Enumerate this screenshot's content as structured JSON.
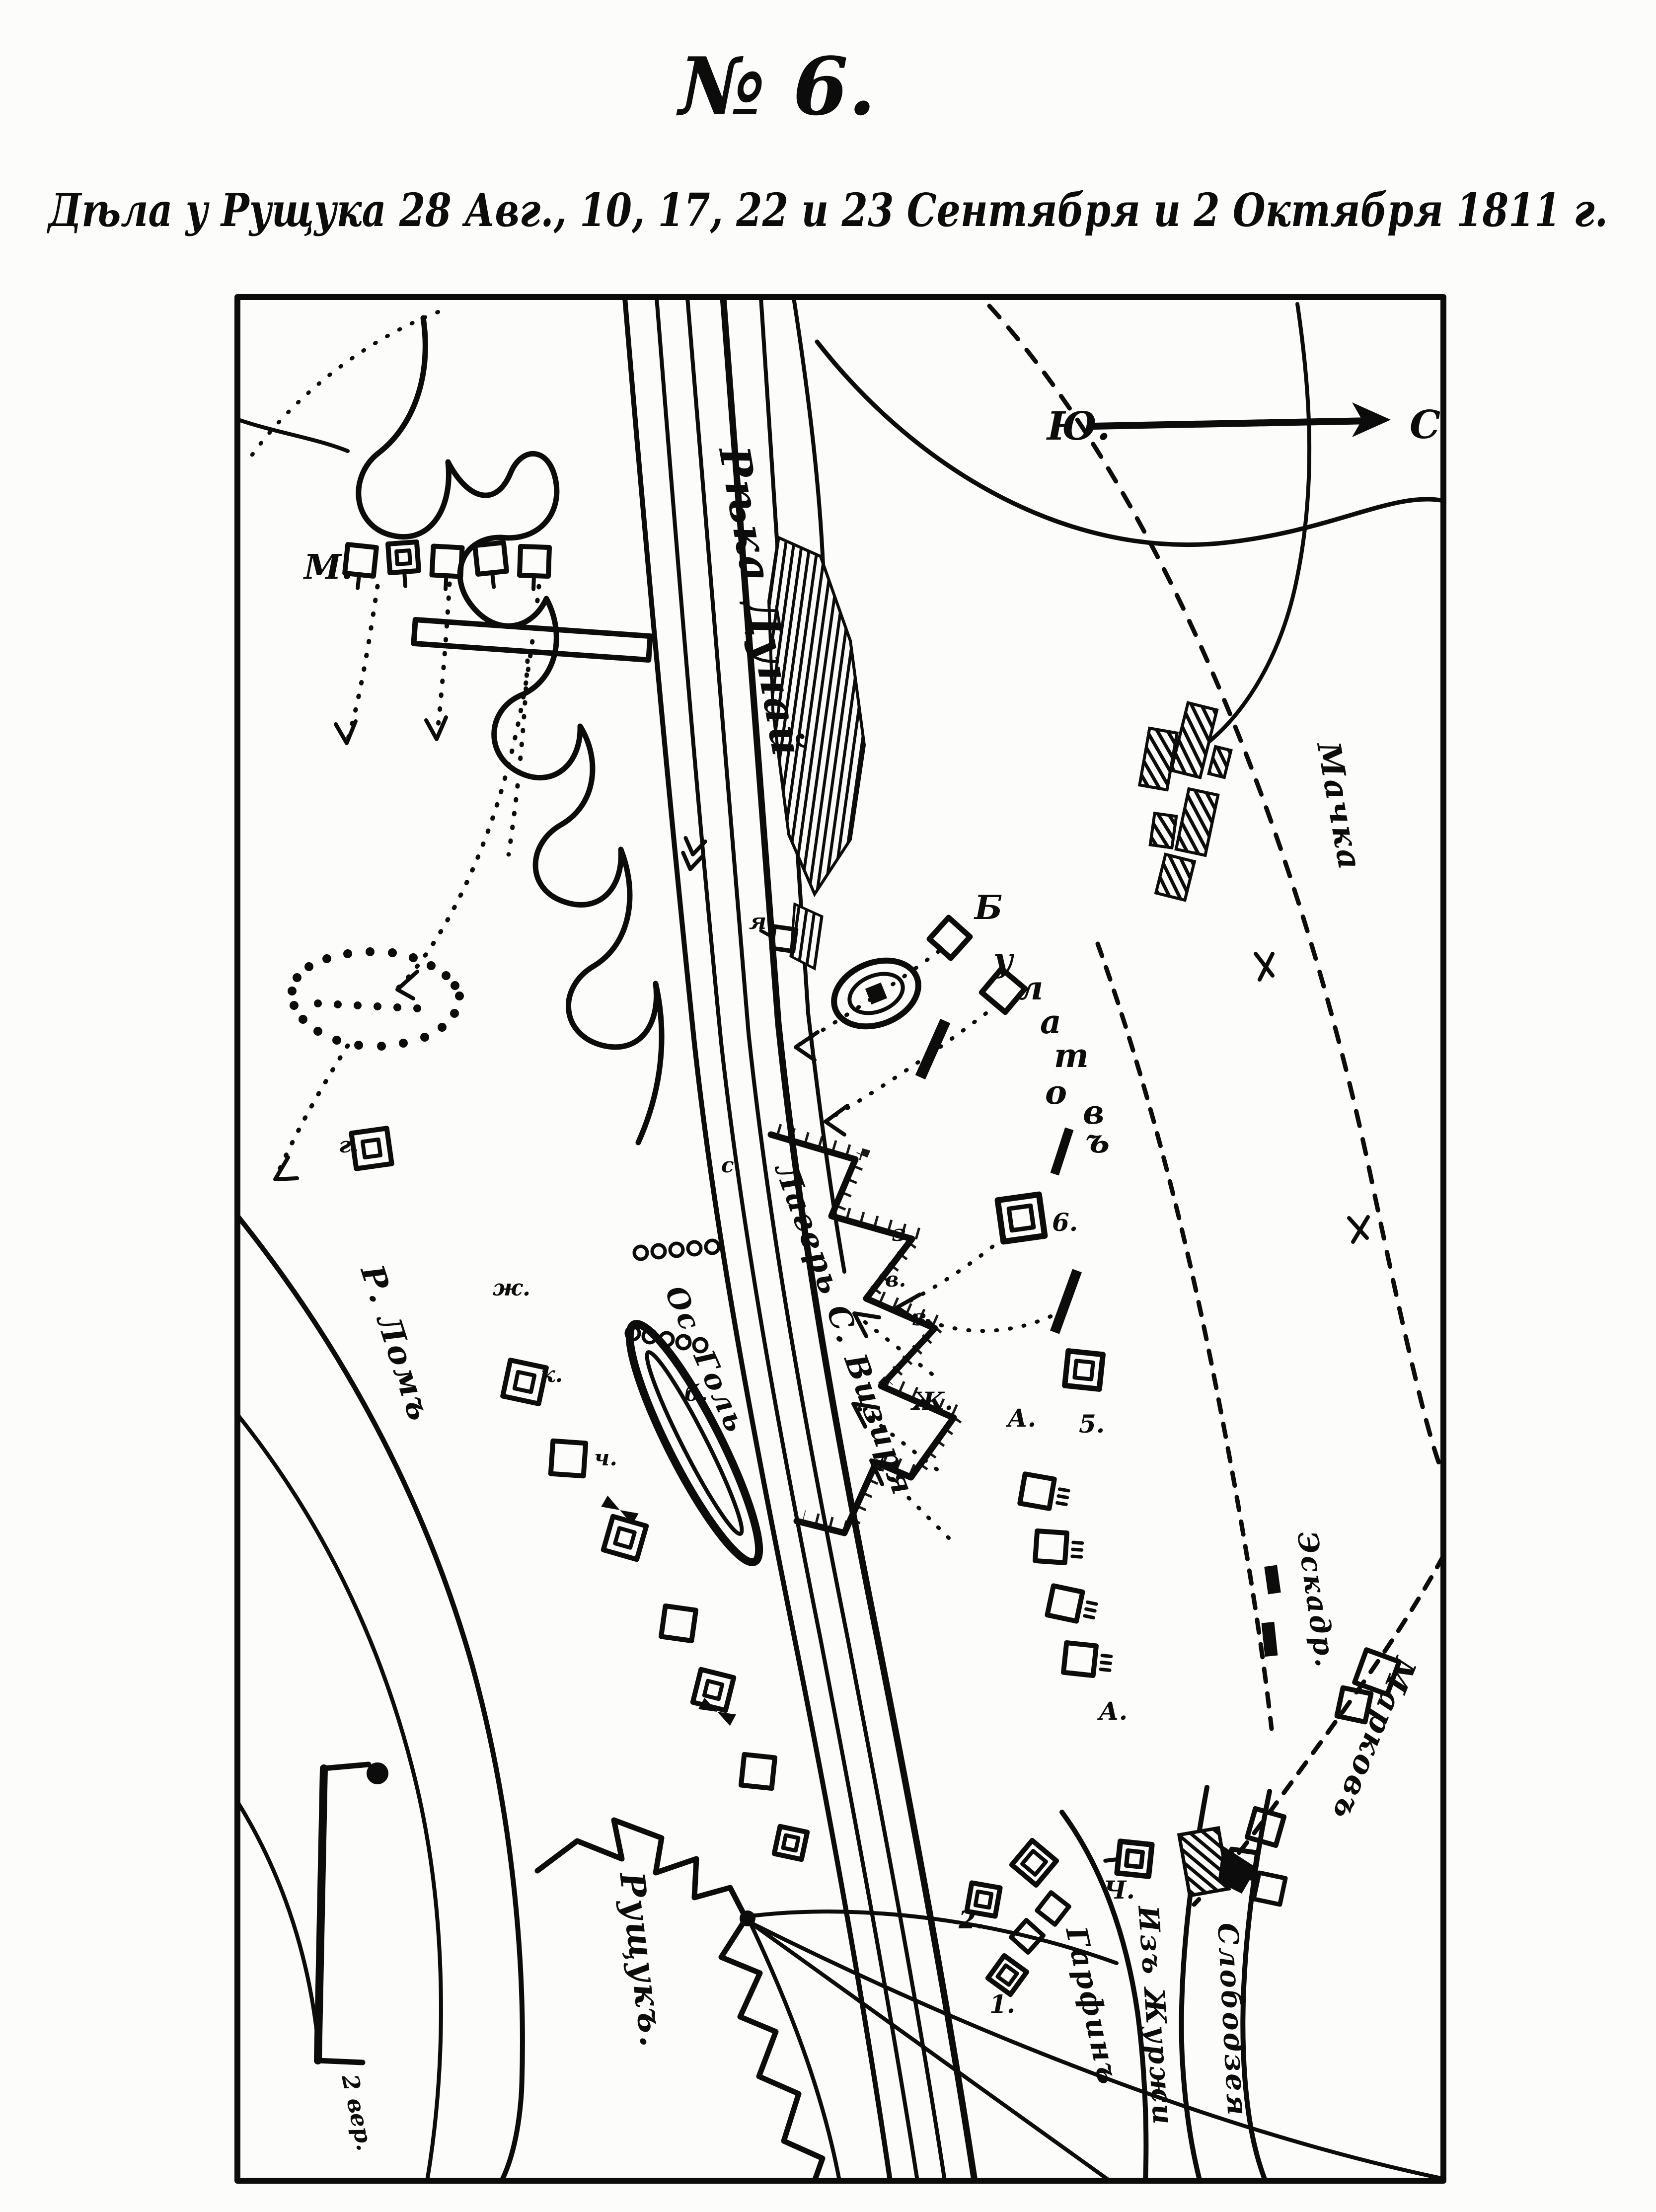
{
  "page": {
    "title": "№ 6.",
    "subtitle": "Дѣла у Рущука 28 Авг., 10, 17, 22 и 23 Сентября и 2 Октября 1811 г."
  },
  "map": {
    "compass": {
      "south": "Ю.",
      "north": "С."
    },
    "scale_label": "2 вер.",
    "labels": {
      "river_danube": "Рѣка Дунай",
      "river_lom": "Р. Ломъ",
      "ruschuk": "Рущукъ.",
      "machka": "Мачка",
      "markov": "Марковъ",
      "slobodzeya": "Слободзея",
      "iz_zhurzhi": "Изъ Журжи",
      "eskadr": "Эскадр.",
      "vizier_camp": "Лагерь С. Визиря",
      "island_gol": "Ос. Голь",
      "garfin": "Гарфинъ",
      "m_battery": "М."
    },
    "scattered_letters": [
      {
        "ch": "Б"
      },
      {
        "ch": "у"
      },
      {
        "ch": "л"
      },
      {
        "ch": "а"
      },
      {
        "ch": "т"
      },
      {
        "ch": "о"
      },
      {
        "ch": "в"
      },
      {
        "ch": "ъ"
      }
    ],
    "point_labels": [
      {
        "text": "6."
      },
      {
        "text": "5."
      },
      {
        "text": "А."
      },
      {
        "text": "А."
      },
      {
        "text": "Ч."
      },
      {
        "text": "2."
      },
      {
        "text": "1."
      },
      {
        "text": "з."
      },
      {
        "text": "з."
      },
      {
        "text": "Ж."
      },
      {
        "text": "в."
      },
      {
        "text": "б."
      },
      {
        "text": "ж."
      },
      {
        "text": "к."
      },
      {
        "text": "с."
      },
      {
        "text": "я."
      },
      {
        "text": "г."
      },
      {
        "text": "ч."
      }
    ]
  }
}
